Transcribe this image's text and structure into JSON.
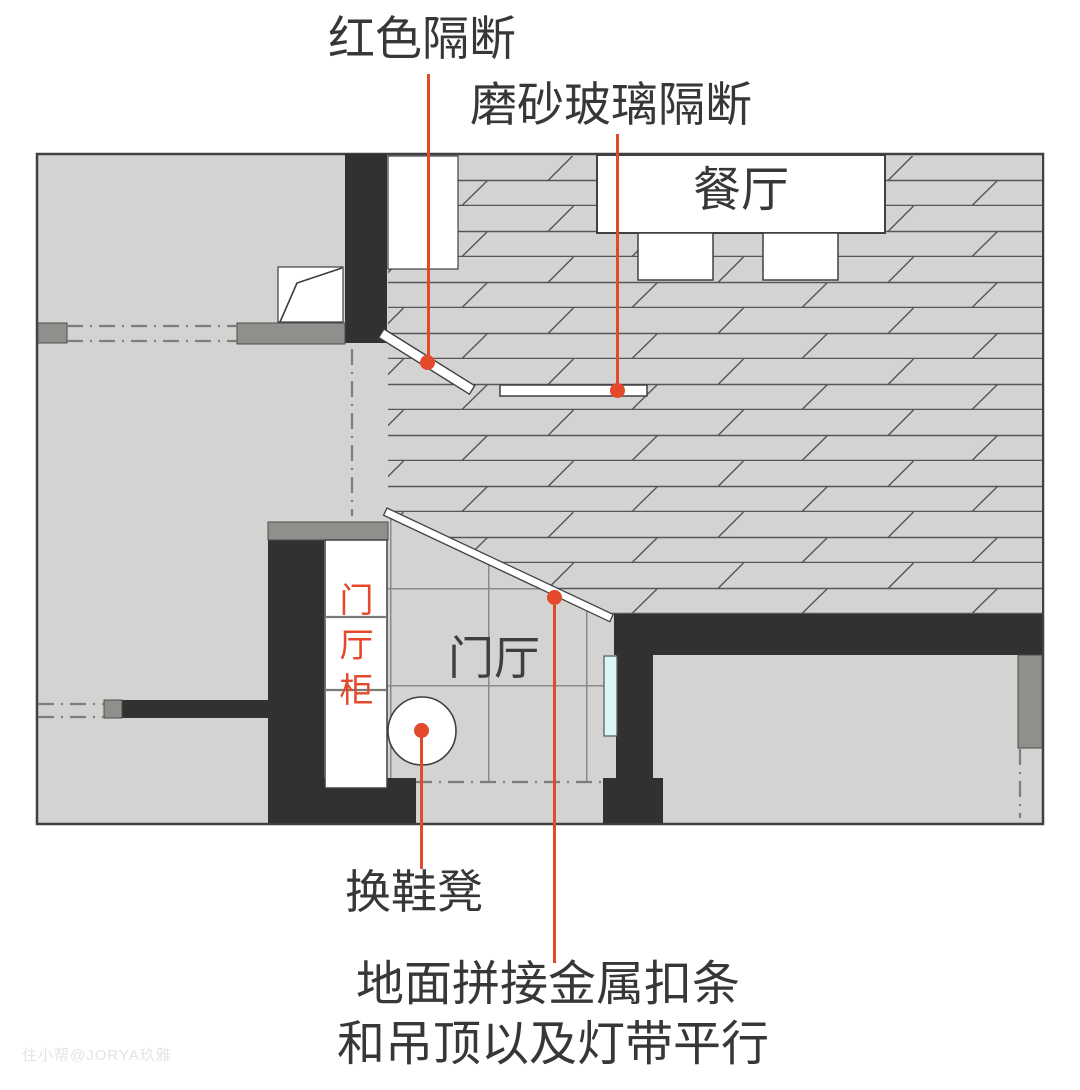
{
  "annotations": {
    "red_partition": "红色隔断",
    "frosted_glass_partition": "磨砂玻璃隔断",
    "shoe_stool": "换鞋凳",
    "metal_strip_line1": "地面拼接金属扣条",
    "metal_strip_line2": "和吊顶以及灯带平行"
  },
  "rooms": {
    "dining_room": "餐厅",
    "entry_hall": "门厅",
    "hall_cabinet": "门厅柜"
  },
  "watermark": "住小帮@JORYA玖雅",
  "colors": {
    "accent": "#e4492b",
    "wall": "#333031",
    "floor": "#d3d3d2",
    "mid": "#8f8f8c",
    "outline": "#404042",
    "glass": "#d9f6f2"
  }
}
